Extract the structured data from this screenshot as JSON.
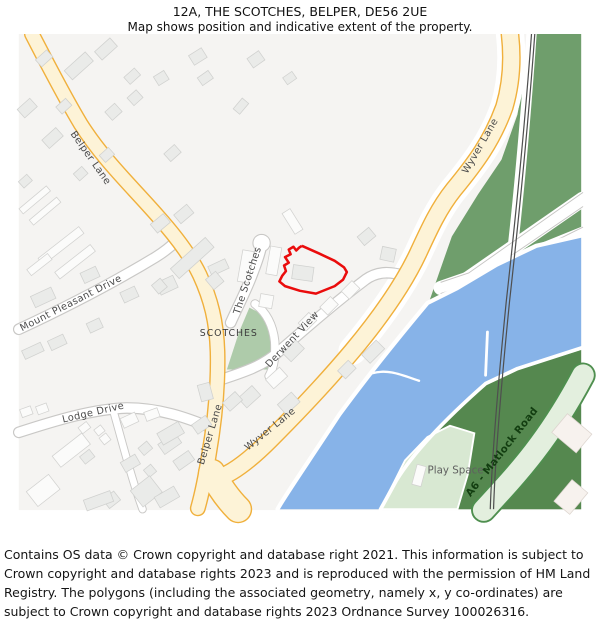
{
  "header": {
    "title": "12A, THE SCOTCHES, BELPER, DE56 2UE",
    "subtitle": "Map shows position and indicative extent of the property."
  },
  "map": {
    "area_label": "SCOTCHES",
    "play_space_label": "Play Space",
    "roads": {
      "belper_lane": "Belper Lane",
      "wyver_lane": "Wyver Lane",
      "the_scotches": "The Scotches",
      "mount_pleasant_drive": "Mount Pleasant Drive",
      "lodge_drive": "Lodge Drive",
      "derwent_view": "Derwent View",
      "a6_matlock_road": "A6 - Matlock Road"
    },
    "colors": {
      "bg": "#f5f4f2",
      "road-fill": "#fdf3d7",
      "road-casing": "#f0b03c",
      "white-road-casing": "#c9c8c6",
      "field-green": "#6f9e6c",
      "dark-green": "#55884f",
      "park-green": "#aecbaa",
      "play-green": "#d8e8d2",
      "a6-fill": "#e3efde",
      "a6-casing": "#4f8f4f",
      "river": "#87b3e8",
      "railway": "#4f4f4f",
      "building-fill": "#eaebe9",
      "building-stroke": "#d0d1cf",
      "building-white": "#fbfbfa",
      "property-red": "#ea0c0c"
    }
  },
  "footer": {
    "copyright": "Contains OS data © Crown copyright and database right 2021. This information is subject to Crown copyright and database rights 2023 and is reproduced with the permission of HM Land Registry. The polygons (including the associated geometry, namely x, y co-ordinates) are subject to Crown copyright and database rights 2023 Ordnance Survey 100026316."
  }
}
